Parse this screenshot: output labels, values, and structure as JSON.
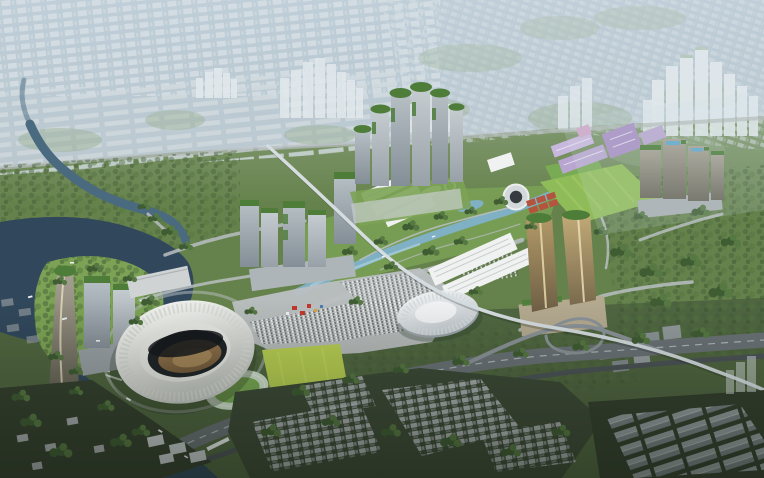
{
  "image": {
    "title": "Aerial rendering of a riverside sports-city masterplan",
    "description": "Daytime bird's-eye architectural visualization: a new development with a white oval stadium (open roof, sand-colored pitch), a white domed arena, a twisted landmark tower on a river island, clusters of high-rise towers with terraced green roofs, two bronze-gold towers, lavender office slabs, long white exhibition halls, a central park with a winding light-blue canal, practice track and bright green fields, a highway and elevated monorail crossing the foreground, dense low-rise urban village and warehouses at the bottom, and a hazy blue-grey city fading into the horizon.",
    "style": "photorealistic masterplan rendering, hazy atmosphere, no visible text or watermark",
    "landmarks": [
      {
        "name": "main-stadium",
        "desc": "large white oval stadium, open roof showing dark rim shadow and brown pitch"
      },
      {
        "name": "indoor-arena",
        "desc": "white ribbed dome arena east of the stadium"
      },
      {
        "name": "twisted-tower",
        "desc": "slender twisting tower with green crown on river island, west"
      },
      {
        "name": "golden-towers",
        "desc": "pair of bronze-gold glass towers with rooftop greenery, center-south"
      },
      {
        "name": "north-tower-cluster",
        "desc": "row of high-rise towers with stepped green rooftop terraces, top-center"
      },
      {
        "name": "west-tower-cluster",
        "desc": "mid-rise glass towers with green roofs, center-left"
      },
      {
        "name": "east-tower-cluster",
        "desc": "glass towers with rooftop pools, right"
      },
      {
        "name": "purple-campus",
        "desc": "lavender-toned office slabs, right of center"
      },
      {
        "name": "exhibition-halls",
        "desc": "long white ridged halls"
      },
      {
        "name": "central-park",
        "desc": "park with winding canal, ponds and white pavilions"
      },
      {
        "name": "small-round-stadium",
        "desc": "small circular venue with dark center"
      },
      {
        "name": "red-courts",
        "desc": "grid of red sports courts"
      },
      {
        "name": "athletics-track",
        "desc": "practice running track with green infield"
      },
      {
        "name": "bright-field",
        "desc": "vivid yellow-green training pitch"
      },
      {
        "name": "striped-lawn",
        "desc": "large mown lawn, right-center"
      },
      {
        "name": "river",
        "desc": "dark slate river and bay with small white boats"
      },
      {
        "name": "monorail",
        "desc": "elevated light-grey guideway crossing the district diagonally"
      },
      {
        "name": "highway",
        "desc": "multi-lane corridor with ramps and railway along the foreground"
      },
      {
        "name": "urban-village",
        "desc": "dense grey low-rise houses among dark trees, bottom"
      },
      {
        "name": "warehouses",
        "desc": "rows of gabled industrial sheds, bottom-right"
      },
      {
        "name": "distant-city",
        "desc": "hazy blue-grey urban fabric with translucent tower clusters, horizon"
      }
    ],
    "palette": {
      "hazeTop": "#9db2c2",
      "hazeMid": "#b6c4cd",
      "blockLight": "#d6dfe3",
      "towerWhite": "#e7edf0",
      "greenMid": "#66824c",
      "greenLight": "#7ca355",
      "greenDark": "#4c6140",
      "canopy": "#46603a",
      "fieldBright": "#b8cf52",
      "lawn": "#8fbc58",
      "trackRing": "#cfe0cc",
      "trackInfield": "#79aa54",
      "waterDark": "#31485c",
      "waterMid": "#4a6a80",
      "waterLight": "#7fb0c4",
      "roadLight": "#b9bfc2",
      "road": "#8b9399",
      "roadDark": "#6a7277",
      "rail": "#4c5357",
      "monorail": "#d6dde0",
      "stadiumOpening": "#1f2428",
      "pitchBrown": "#8a6a45",
      "glassLight": "#b6bfc4",
      "glassDark": "#848e96",
      "greenRoof": "#4e7d3a",
      "gold": "#b39a68",
      "goldDark": "#6e5f45",
      "bronze": "#99948a",
      "pool": "#5fa8c9",
      "purpleLight": "#c8b7dd",
      "purpleMid": "#b9a6d0",
      "purpleDark": "#a78fc2",
      "plaza": "#bcc0c2",
      "tentRed": "#c0392b",
      "houseLight": "#b2b8b9",
      "houseDark": "#8d9497",
      "shedRoof": "#9aa2a6",
      "villageGround": "#3d4a37",
      "forestDark": "#35402f",
      "boat": "#eef2f2",
      "white": "#f0f2f1"
    }
  }
}
